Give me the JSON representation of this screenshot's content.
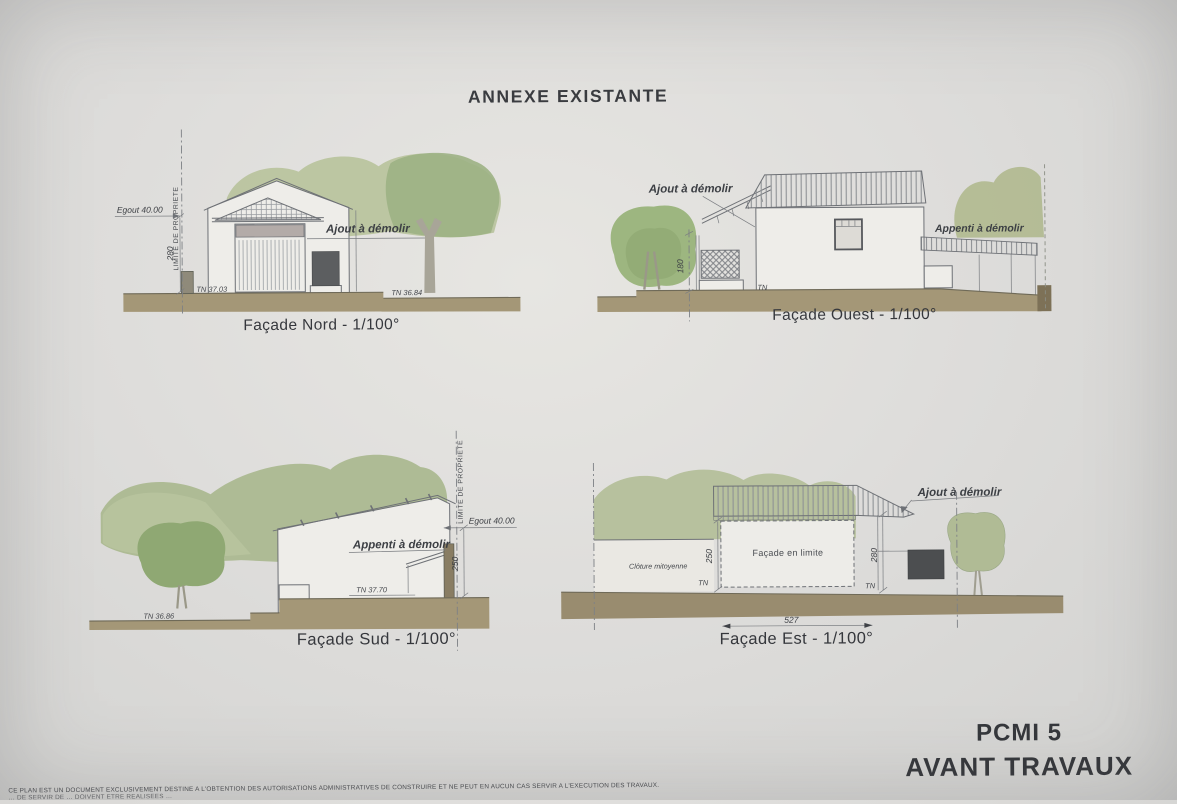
{
  "title": "ANNEXE EXISTANTE",
  "facades": {
    "nord": {
      "caption": "Façade Nord - 1/100°",
      "labels": {
        "egout": "Egout 40.00",
        "limite": "LIMITE DE PROPRIETE",
        "dim280": "280",
        "tn_left": "TN 37.03",
        "tn_right": "TN 36.84",
        "ajout": "Ajout à démolir"
      }
    },
    "ouest": {
      "caption": "Façade Ouest - 1/100°",
      "labels": {
        "ajout": "Ajout à démolir",
        "appenti": "Appenti à démolir",
        "dim180": "180",
        "tn": "TN"
      }
    },
    "sud": {
      "caption": "Façade Sud - 1/100°",
      "labels": {
        "appenti": "Appenti à démolir",
        "limite": "LIMITE DE PROPRIETE",
        "egout": "Egout 40.00",
        "dim250": "250",
        "tn_mid": "TN 37.70",
        "tn_left": "TN 36.86"
      }
    },
    "est": {
      "caption": "Façade Est - 1/100°",
      "labels": {
        "cloture": "Clôture mitoyenne",
        "facade_en_limite": "Façade en limite",
        "ajout": "Ajout à démolir",
        "dim250": "250",
        "dim280": "280",
        "dim527": "527",
        "tn_left": "TN",
        "tn_right": "TN"
      }
    }
  },
  "stamp": {
    "code": "PCMI 5",
    "phase": "AVANT TRAVAUX"
  },
  "disclaimer": {
    "line1": "CE PLAN EST UN DOCUMENT EXCLUSIVEMENT DESTINE A L'OBTENTION DES AUTORISATIONS ADMINISTRATIVES DE CONSTRUIRE ET NE PEUT EN AUCUN CAS SERVIR A L'EXECUTION DES TRAVAUX.",
    "line2": "… DE SERVIR DE … DOIVENT ETRE REALISEES …"
  },
  "colors": {
    "paper": "#dedddb",
    "ground": "#a49777",
    "ground_dark": "#998c6f",
    "vegetation": "#a9b78d",
    "vegetation_light": "#b6c29a",
    "tree_dark": "#8fa873",
    "demolish_fill": "#4c4e50",
    "line": "#6e7176"
  }
}
